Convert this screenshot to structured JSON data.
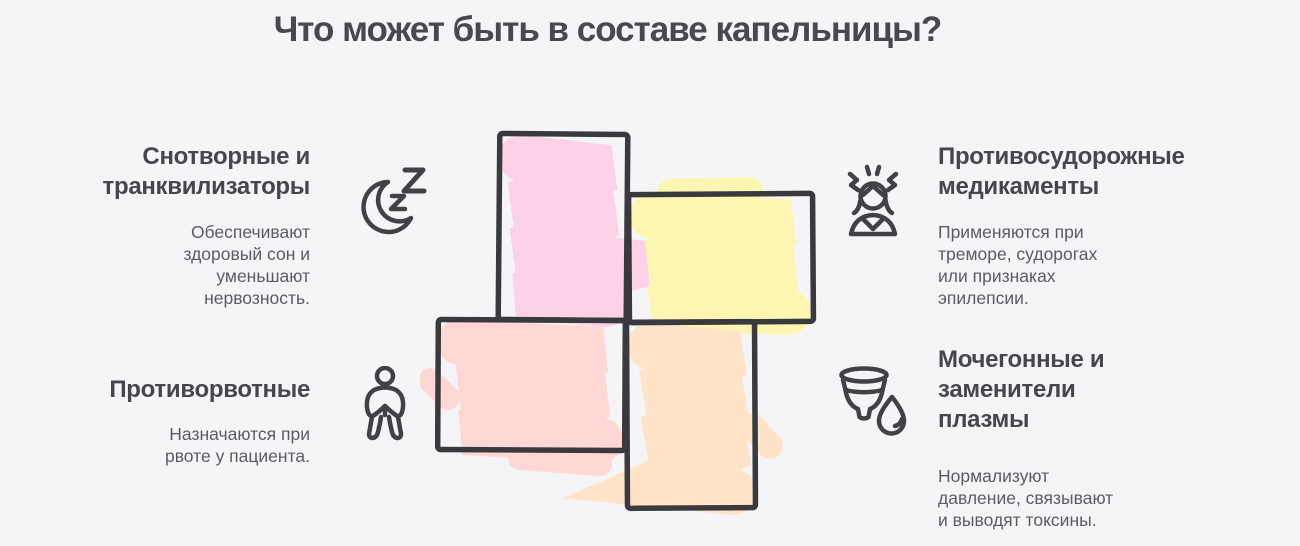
{
  "title": "Что может быть в составе капельницы?",
  "sections": {
    "top_left": {
      "heading": "Снотворные и\nтранквилизаторы",
      "body": "Обеспечивают\nздоровый сон и\nуменьшают\nнервозность.",
      "icon": "moon-zzz-icon"
    },
    "top_right": {
      "heading": "Противосудорожные\nмедикаменты",
      "body": "Применяются при\nтреморе, судорогах\nили признаках\nэпилепсии.",
      "icon": "stressed-person-icon"
    },
    "bottom_left": {
      "heading": "Противорвотные",
      "body": "Назначаются при\nрвоте у пациента.",
      "icon": "person-holding-stomach-icon"
    },
    "bottom_right": {
      "heading": "Мочегонные и\nзаменители\nплазмы",
      "body": "Нормализуют\nдавление, связывают\nи выводят токсины.",
      "icon": "cup-and-drop-icon"
    }
  },
  "cross": {
    "outline_color": "#3a3a3e",
    "blocks": [
      {
        "position": "top",
        "color": "#fdd2e9"
      },
      {
        "position": "right",
        "color": "#fdf6b3"
      },
      {
        "position": "left",
        "color": "#ffd7d4"
      },
      {
        "position": "bottom",
        "color": "#ffe4ca"
      }
    ]
  },
  "colors": {
    "background": "#f5f5f8",
    "title_text": "#48484e",
    "heading_text": "#46464c",
    "body_text": "#5b5b62",
    "icon_stroke": "#414146"
  }
}
